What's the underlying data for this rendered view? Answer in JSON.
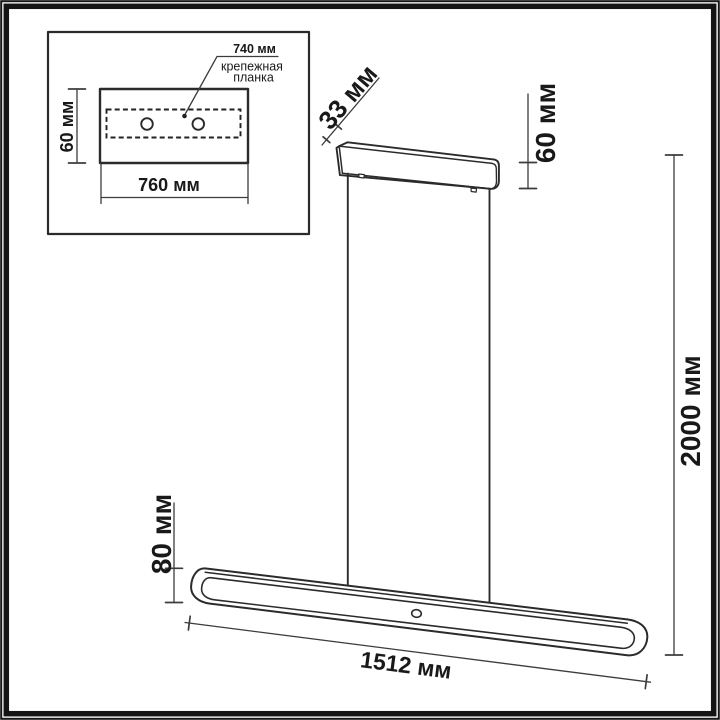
{
  "drawing": {
    "kind": "linear pendant light — dimensional drawing",
    "units": "мм"
  },
  "colors": {
    "background": "#ffffff",
    "frame": "#141414",
    "outline": "#2b2b2b",
    "dimension_line": "#3c3c3c",
    "text": "#191919"
  },
  "inset": {
    "plate_height_label": "60 мм",
    "plate_width_label": "760 мм",
    "holes_spacing_label": "740 мм",
    "callout_line1": "крепежная",
    "callout_line2": "планка"
  },
  "fixture": {
    "canopy_depth_label": "33 мм",
    "canopy_height_label": "60 мм",
    "suspension_height_label": "2000 мм",
    "bar_height_label": "80 мм",
    "bar_length_label": "1512 мм"
  },
  "dimensions": [
    {
      "part": "mounting plate",
      "measure": "width",
      "value": 760,
      "unit": "мм"
    },
    {
      "part": "mounting plate",
      "measure": "height",
      "value": 60,
      "unit": "мм"
    },
    {
      "part": "mounting bracket holes",
      "measure": "spacing",
      "value": 740,
      "unit": "мм"
    },
    {
      "part": "canopy",
      "measure": "depth",
      "value": 33,
      "unit": "мм"
    },
    {
      "part": "canopy",
      "measure": "height",
      "value": 60,
      "unit": "мм"
    },
    {
      "part": "suspension",
      "measure": "overall height",
      "value": 2000,
      "unit": "мм"
    },
    {
      "part": "light bar",
      "measure": "height",
      "value": 80,
      "unit": "мм"
    },
    {
      "part": "light bar",
      "measure": "length",
      "value": 1512,
      "unit": "мм"
    }
  ]
}
